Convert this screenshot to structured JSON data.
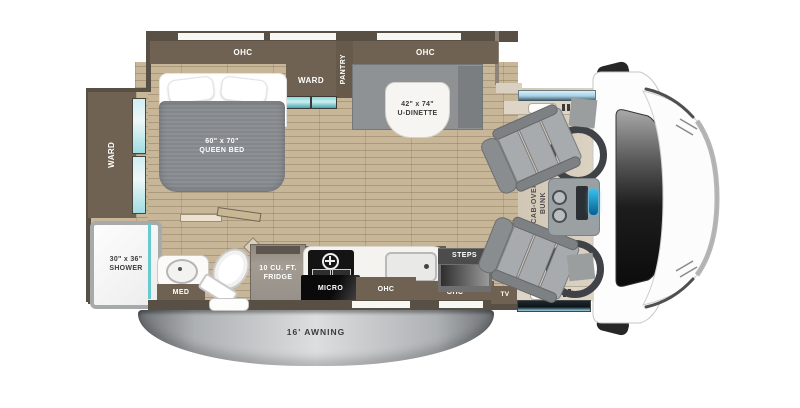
{
  "labels": {
    "ohc_bed": "OHC",
    "ohc_dinette": "OHC",
    "ward_slide": "WARD",
    "ward_rear": "WARD",
    "pantry": "PANTRY",
    "bed_size": "60\" x 70\"",
    "bed_name": "QUEEN BED",
    "dinette_size": "42\" x 74\"",
    "dinette_name": "U-DINETTE",
    "shower_size": "30\" x 36\"",
    "shower_name": "SHOWER",
    "med": "MED",
    "fridge_size": "10 CU. FT.",
    "fridge_name": "FRIDGE",
    "micro": "MICRO",
    "ohc_kitchen_left": "OHC",
    "ohc_kitchen_right": "OHC",
    "steps": "STEPS",
    "tv": "TV",
    "bunk_line1": "CAB-OVER",
    "bunk_line2": "BUNK",
    "awning": "16' AWNING"
  },
  "colors": {
    "cabinet_brown": "#6f6252",
    "wall_dark": "#584f45",
    "floor_tan": "#c8b698",
    "cab_floor": "#d5cab9",
    "accent_teal": "#66cace",
    "window_blue": "#bfe4f2",
    "seat_gray": "#a8abae",
    "awning_silver": "#dcdedf",
    "console_blue": "#35c2f2"
  }
}
